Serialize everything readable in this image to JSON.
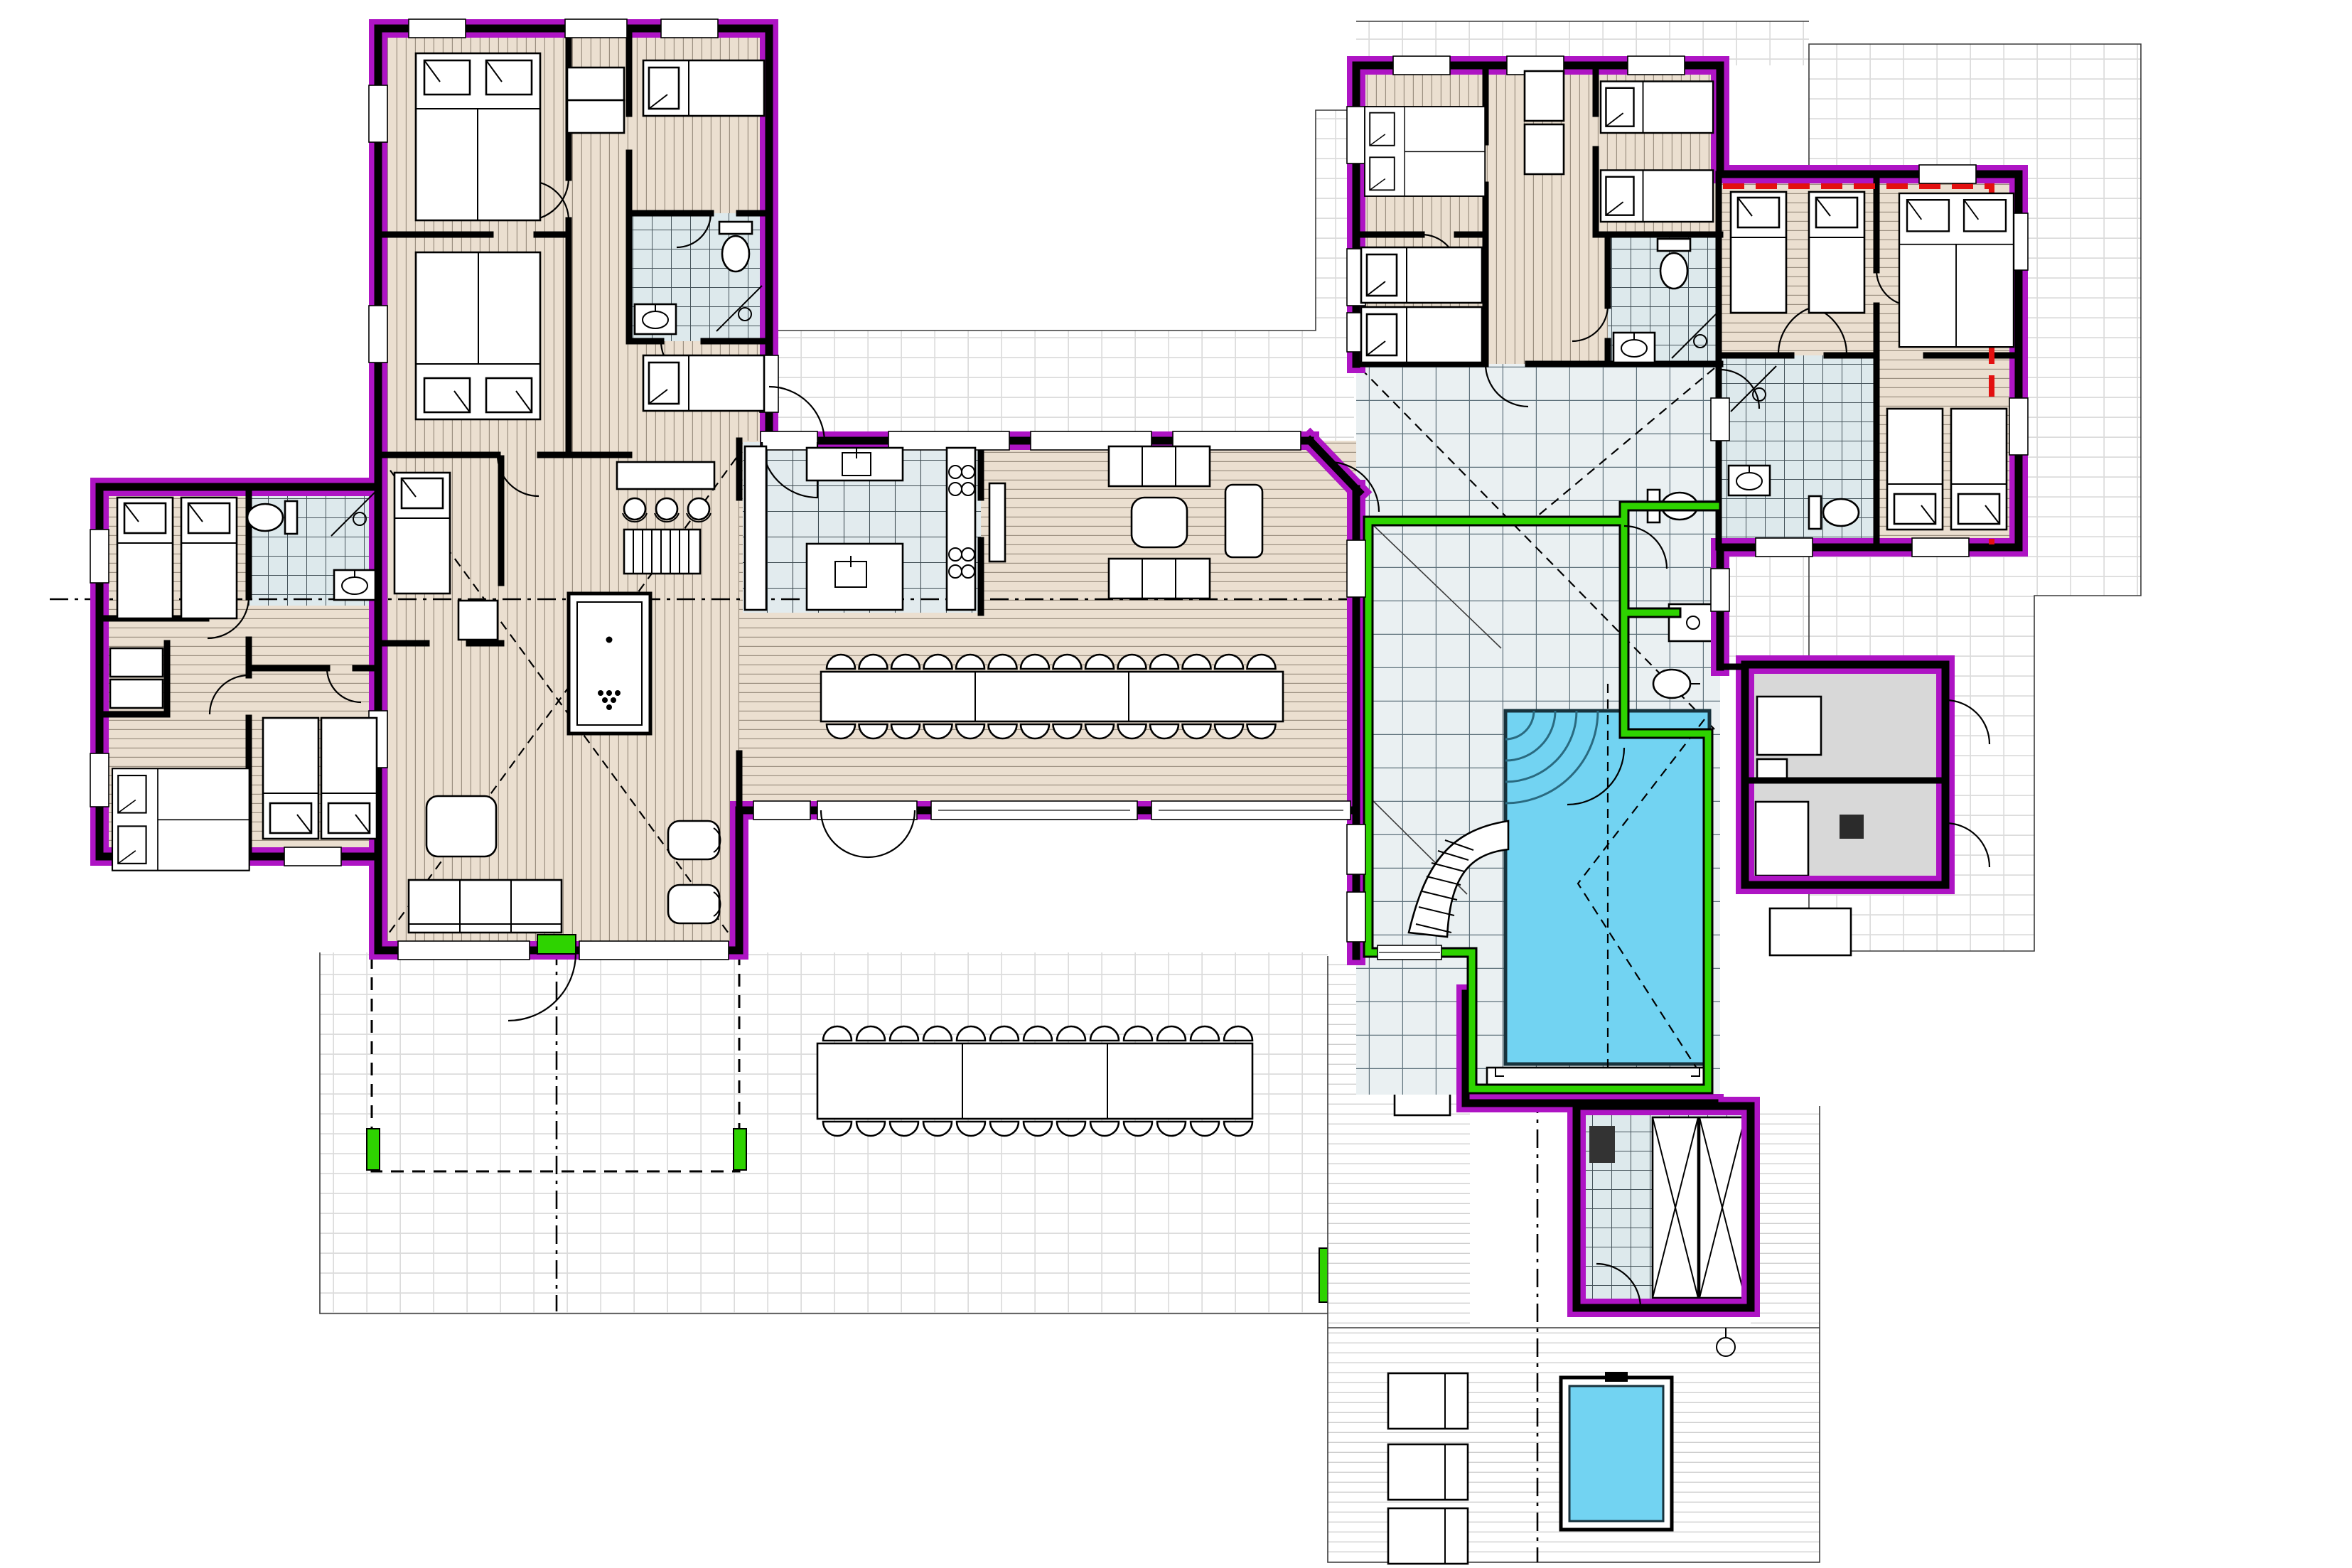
{
  "document": {
    "type": "architectural-floor-plan",
    "view": "top-down ground floor plan of a large villa with indoor pool, sauna and terraces",
    "visible_text": []
  },
  "palette": {
    "paper": "#ffffff",
    "wall": "#000000",
    "insulation_magenta": "#ae14c4",
    "highlight_green": "#2ed300",
    "accent_red": "#e31010",
    "pool_water": "#72d3f2",
    "wood_floor": "#ebdfd0",
    "wood_line": "#9b8f80",
    "tile_big": "#eaf0f2",
    "tile_big_line": "#5d707a",
    "bath_tile": "#dde9ec",
    "kitchen_tile": "#e2ebee",
    "terrace_line": "#dcdcdc",
    "deck_line": "#cfcfcf",
    "gray_room": "#d8d8d8",
    "furniture": "#ffffff"
  },
  "legend": {
    "floors": [
      {
        "name": "wood-plank-flooring",
        "fill": "#ebdfd0"
      },
      {
        "name": "ceramic-tile-wet-rooms",
        "fill": "#dde9ec"
      },
      {
        "name": "large-tile-pool-hall",
        "fill": "#eaf0f2"
      },
      {
        "name": "outdoor-terrace-tiles",
        "fill": "#ffffff"
      },
      {
        "name": "outdoor-wood-deck",
        "fill": "#ffffff"
      },
      {
        "name": "technical-room",
        "fill": "#d8d8d8"
      }
    ],
    "walls": [
      {
        "name": "insulated-exterior-wall",
        "color": "#ae14c4"
      },
      {
        "name": "structural-wall",
        "color": "#000000"
      },
      {
        "name": "glazed-pool-enclosure-wall",
        "color": "#2ed300"
      },
      {
        "name": "fire-separation-line",
        "color": "#e31010"
      }
    ]
  },
  "inventory": {
    "double_beds": 5,
    "single_beds": 11,
    "toilets": 5,
    "wash_basins": 6,
    "showers": 4,
    "indoor_pool": 1,
    "pool_slide": 1,
    "hot_tub": 1,
    "sauna_benches": 2,
    "sun_loungers": 3,
    "billiard_table": 1,
    "bar_stools": 3,
    "indoor_dining_chairs": 28,
    "outdoor_dining_chairs": 26,
    "kitchen_islands": 2,
    "cooktop_burners": 8,
    "sofas": 3,
    "armchairs": 4
  }
}
